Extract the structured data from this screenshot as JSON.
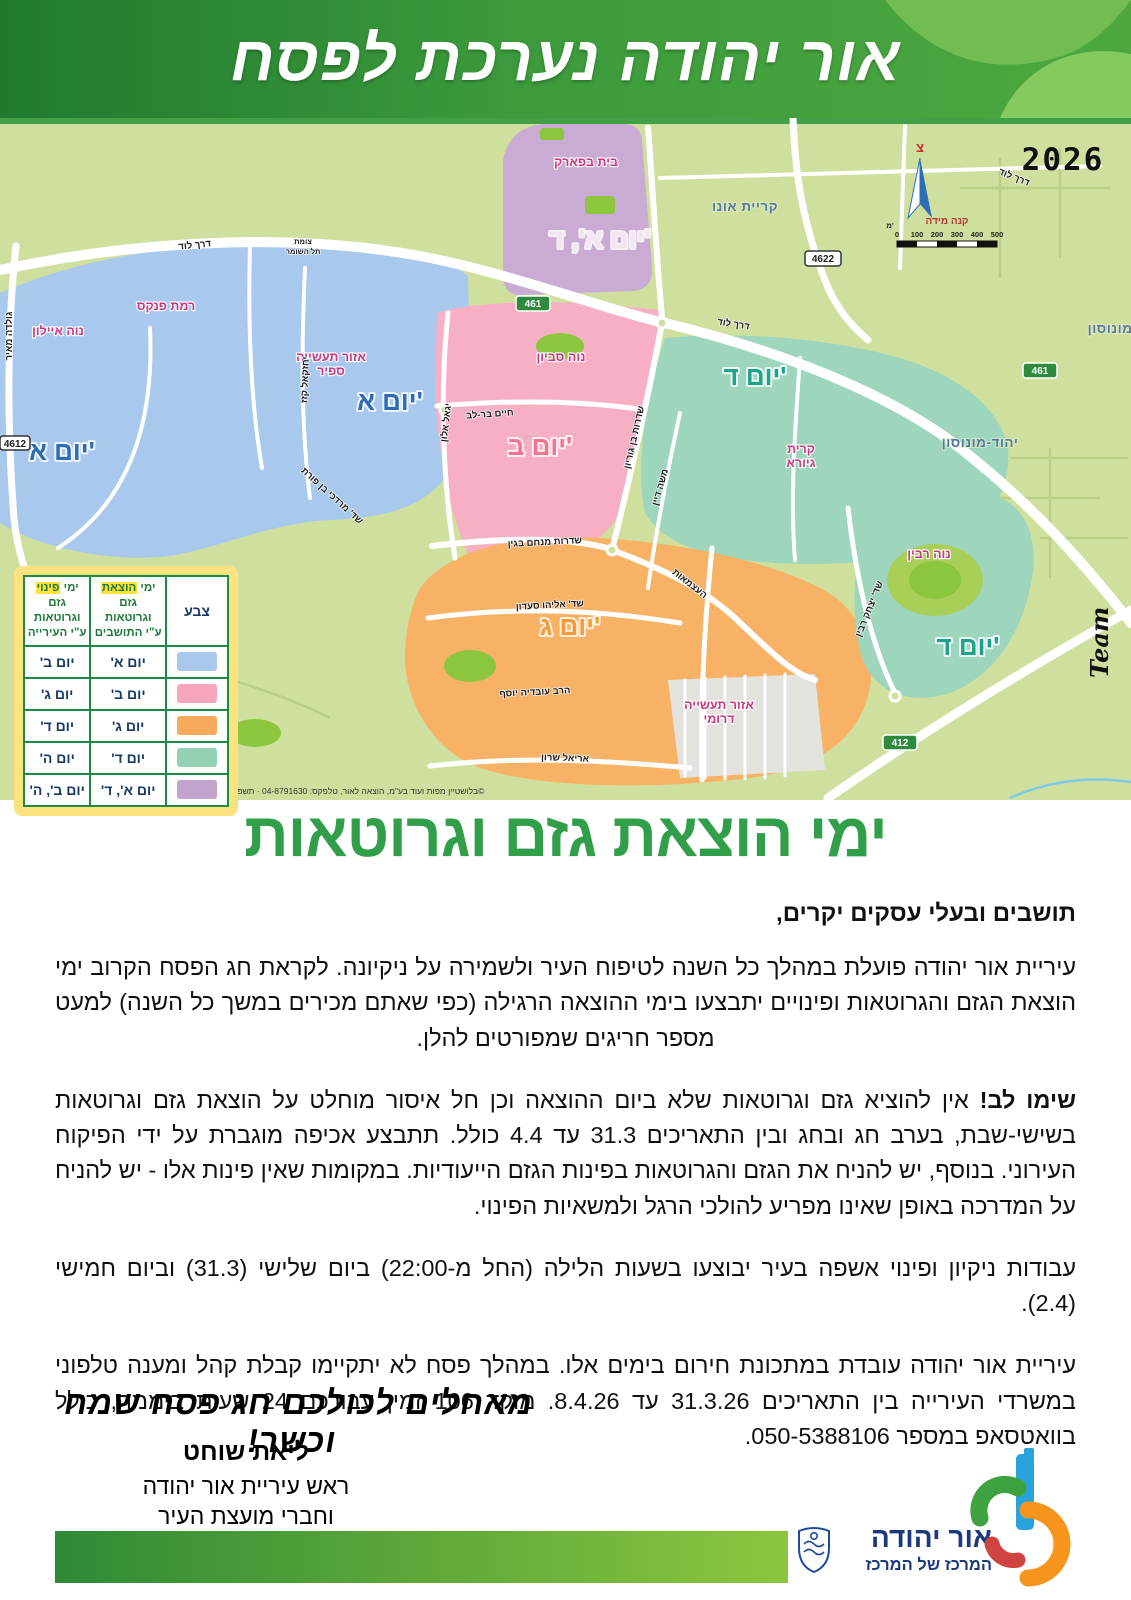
{
  "header": {
    "title": "אור יהודה נערכת לפסח"
  },
  "map": {
    "year": "2026",
    "north_label": "צ",
    "scale_title": "קנה מידה",
    "scale_unit": "מ'",
    "scale_ticks": [
      "0",
      "100",
      "200",
      "300",
      "400",
      "500"
    ],
    "watermark": "Team",
    "credit": "©בלושטיין מפות ועוד בע\"מ, הוצאה לאור, טלפקס: 04-8791630 · תשפ\"ו · 2026",
    "zone_colors": {
      "blue": "#a9c8ee",
      "pink": "#f7afc4",
      "orange": "#f8b266",
      "teal": "#9dd6bd",
      "purple": "#c9abd4",
      "industrial": "#e3e2dd"
    },
    "day_labels": {
      "blue_east": "יום א'",
      "blue_west": "יום א'",
      "purple": "יום א', ד'",
      "pink": "יום ב'",
      "teal_north": "יום ד'",
      "teal_south": "יום ד'",
      "orange": "יום ג'"
    },
    "neighborhoods": {
      "neve_ayalon": "נוה איילון",
      "ramat_pinkas": "רמת פנקס",
      "saphir_line1": "אזור תעשייה",
      "saphir_line2": "ספיר",
      "beit_bapark": "בית בפארק",
      "neve_savyon": "נוה סביון",
      "giora_line1": "קרית",
      "giora_line2": "גיורא",
      "neve_rabin": "נוה רבין",
      "southern_line1": "אזור תעשייה",
      "southern_line2": "דרומי"
    },
    "cities": {
      "kiryat_ono": "קריית אונו",
      "yehud_north": "יהוד-מונוסון",
      "yehud_south": "יהוד-מונוסון"
    },
    "roads": {
      "lod_nw": "דרך לוד",
      "lod_mid": "דרך לוד",
      "lod_ne": "דרך לוד",
      "golda": "גולדה מאיר",
      "tzomet_line1": "צומת",
      "tzomet_line2": "תל השומר",
      "yigal_alon": "יגאל אלון",
      "bar_lev": "חיים בר-לב",
      "ben_gurion": "שדרות בן גוריון",
      "moshe_dayan": "משה דיין",
      "menachem_begin": "שדרות מנחם בגין",
      "eliyahu_saadon": "שד' אליהו סעדון",
      "ariel_sharon": "אריאל שרון",
      "ovadia_yosef": "הרב עובדיה יוסף",
      "haatzmaut": "העצמאות",
      "yitzhak_rabin": "שד' יצחק רבין",
      "ben_porat": "שד' מרדכי בן פורת",
      "yechezkel_kazaz": "יחזקאל קזז"
    },
    "route_badges": {
      "r461_west": "461",
      "r461_east": "461",
      "r4622": "4622",
      "r4612": "4612",
      "r412": "412"
    },
    "legend": {
      "col_color": "צבע",
      "col_resident": {
        "l1a": "ימי ",
        "l1hl": "הוצאת",
        "l1b": " גזם",
        "l2": "וגרוטאות",
        "l3": "ע\"י התושבים"
      },
      "col_city": {
        "l1a": "ימי ",
        "l1hl": "פינוי",
        "l1b": " גזם",
        "l2": "וגרוטאות",
        "l3": "ע\"י העירייה"
      },
      "rows": [
        {
          "color": "#a9c8ee",
          "resident": "יום א'",
          "city": "יום ב'"
        },
        {
          "color": "#f9a6bc",
          "resident": "יום ב'",
          "city": "יום ג'"
        },
        {
          "color": "#f8a95c",
          "resident": "יום ג'",
          "city": "יום ד'"
        },
        {
          "color": "#93d1b4",
          "resident": "יום ד'",
          "city": "יום ה'"
        },
        {
          "color": "#c2a3cd",
          "resident": "יום א', ד'",
          "city": "יום ב', ה'"
        }
      ]
    }
  },
  "section": {
    "title": "ימי הוצאת גזם וגרוטאות"
  },
  "body": {
    "salutation": "תושבים ובעלי עסקים יקרים,",
    "p1": "עיריית אור יהודה פועלת במהלך כל השנה לטיפוח העיר ולשמירה על ניקיונה. לקראת חג הפסח הקרוב ימי הוצאת הגזם והגרוטאות ופינויים יתבצעו בימי ההוצאה הרגילה (כפי שאתם מכירים במשך כל השנה) למעט מספר חריגים שמפורטים להלן.",
    "p2_lead": "שימו לב!",
    "p2_rest": " אין להוציא גזם וגרוטאות שלא ביום ההוצאה וכן חל איסור מוחלט על הוצאת גזם וגרוטאות בשישי-שבת, בערב חג ובחג ובין התאריכים 31.3 עד 4.4 כולל. תתבצע אכיפה מוגברת על ידי הפיקוח העירוני. בנוסף, יש להניח את הגזם והגרוטאות בפינות הגזם הייעודיות. במקומות שאין פינות אלו - יש להניח על המדרכה באופן שאינו מפריע להולכי הרגל ולמשאיות הפינוי.",
    "p3": "עבודות ניקיון ופינוי אשפה בעיר יבוצעו בשעות הלילה (החל מ-22:00) ביום שלישי (31.3) וביום חמישי (2.4).",
    "p4": "עיריית אור יהודה עובדת במתכונת חירום בימים אלו. במהלך פסח לא יתקיימו קבלת קהל ומענה טלפוני במשרדי העירייה בין התאריכים 31.3.26 עד 8.4.26. מוקד 106 זמין עבורכם 24 שעות ביממה, כולל בוואטסאפ במספר 050-5388106.",
    "greeting": "מאחלים לכולכם חג פסח שמח וכשר!",
    "signer_name": "ליאת שוחט",
    "signer_role1": "ראש עיריית אור יהודה",
    "signer_role2": "וחברי מועצת העיר"
  },
  "footer": {
    "logo_title": "אור יהודה",
    "logo_subtitle": "המרכז של המרכז"
  }
}
